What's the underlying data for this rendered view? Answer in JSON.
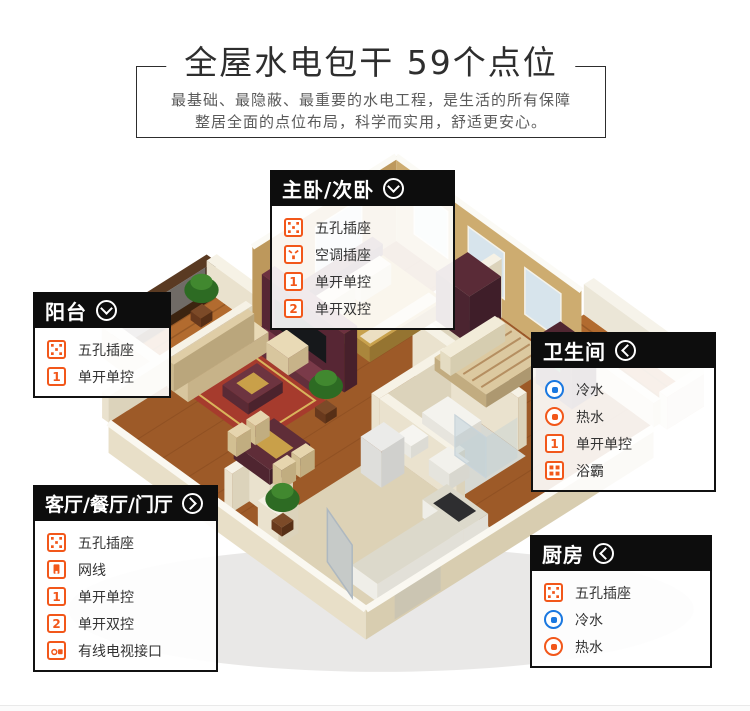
{
  "banner": {
    "title": "全屋水电包干  59个点位",
    "subtitle_line1": "最基础、最隐蔽、最重要的水电工程，是生活的所有保障",
    "subtitle_line2": "整居全面的点位布局，科学而实用，舒适更安心。"
  },
  "colors": {
    "accent_orange": "#f2571a",
    "accent_blue": "#1a78e0",
    "header_black": "#0d0d0d"
  },
  "boxes": {
    "bedroom": {
      "title": "主卧/次卧",
      "chevron": "down",
      "items": [
        {
          "icon": "five-hole-socket",
          "label": "五孔插座"
        },
        {
          "icon": "ac-socket",
          "label": "空调插座"
        },
        {
          "icon": "single-switch",
          "num": "1",
          "label": "单开单控"
        },
        {
          "icon": "double-switch",
          "num": "2",
          "label": "单开双控"
        }
      ]
    },
    "balcony": {
      "title": "阳台",
      "chevron": "down",
      "items": [
        {
          "icon": "five-hole-socket",
          "label": "五孔插座"
        },
        {
          "icon": "single-switch",
          "num": "1",
          "label": "单开单控"
        }
      ]
    },
    "bathroom": {
      "title": "卫生间",
      "chevron": "left",
      "items": [
        {
          "icon": "cold-water",
          "label": "冷水"
        },
        {
          "icon": "hot-water",
          "label": "热水"
        },
        {
          "icon": "single-switch",
          "num": "1",
          "label": "单开单控"
        },
        {
          "icon": "bath-heater",
          "label": "浴霸"
        }
      ]
    },
    "living": {
      "title": "客厅/餐厅/门厅",
      "chevron": "right",
      "items": [
        {
          "icon": "five-hole-socket",
          "label": "五孔插座"
        },
        {
          "icon": "network-port",
          "label": "网线"
        },
        {
          "icon": "single-switch",
          "num": "1",
          "label": "单开单控"
        },
        {
          "icon": "double-switch",
          "num": "2",
          "label": "单开双控"
        },
        {
          "icon": "tv-port",
          "label": "有线电视接口"
        }
      ]
    },
    "kitchen": {
      "title": "厨房",
      "chevron": "left",
      "items": [
        {
          "icon": "five-hole-socket",
          "label": "五孔插座"
        },
        {
          "icon": "cold-water",
          "label": "冷水"
        },
        {
          "icon": "hot-water",
          "label": "热水"
        }
      ]
    }
  }
}
